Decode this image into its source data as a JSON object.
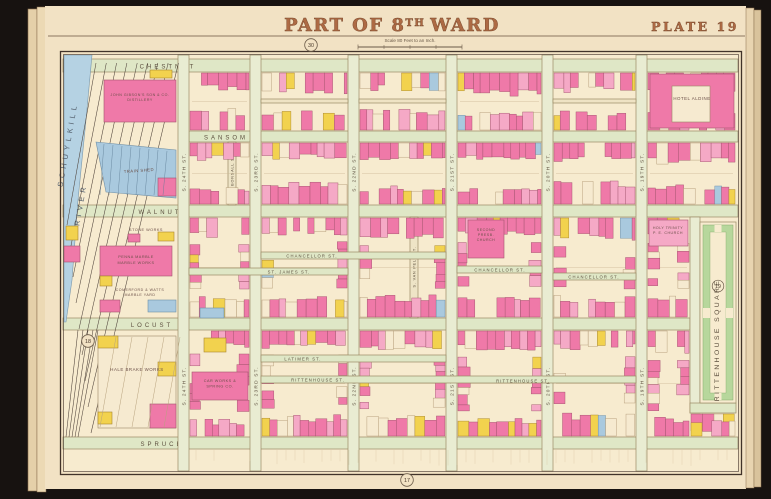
{
  "page": {
    "title_prefix": "PART OF 8",
    "title_sup": "TH",
    "title_suffix": "WARD",
    "plate_label": "PLATE 19",
    "scale_note": "Scale 80 Feet to an Inch."
  },
  "map": {
    "colors": {
      "dark": "#171210",
      "paper": "#f2e2c4",
      "block": "#f7ebcf",
      "street": "#dfe7c6",
      "street_light": "#e9ecd2",
      "street_line": "#9b8a64",
      "pink": "#ef79a8",
      "pink_light": "#f5a9c6",
      "yellow": "#f2d24e",
      "blue": "#a9c9de",
      "cream": "#f6ead0",
      "river": "#b5d2e3",
      "square_green": "#b7d79c",
      "ink": "#5c4f3e",
      "frame": "#41332a",
      "title": "#a96740"
    },
    "river": {
      "line1": "SCHUYLKILL",
      "line2": "RIVER"
    },
    "square": {
      "name": "RITTENHOUSE SQUARE",
      "badge": "19"
    },
    "ref_circles": [
      {
        "n": "30",
        "x": 311,
        "y": 45
      },
      {
        "n": "18",
        "x": 88,
        "y": 341
      },
      {
        "n": "17",
        "x": 407,
        "y": 480
      }
    ],
    "h_streets": [
      {
        "label": "CHESTNUT",
        "x1": 63,
        "x2": 738,
        "y": 59,
        "h": 13,
        "lx": 168,
        "ly": 68.5
      },
      {
        "label": "SANSOM",
        "x1": 189,
        "x2": 738,
        "y": 131,
        "h": 11,
        "lx": 226,
        "ly": 139.5
      },
      {
        "label": "WALNUT",
        "x1": 63,
        "x2": 738,
        "y": 205,
        "h": 12,
        "lx": 160,
        "ly": 214
      },
      {
        "label": "LOCUST",
        "x1": 63,
        "x2": 690,
        "y": 318,
        "h": 12,
        "lx": 152,
        "ly": 327
      },
      {
        "label": "SPRUCE",
        "x1": 63,
        "x2": 738,
        "y": 437,
        "h": 12,
        "lx": 162,
        "ly": 446
      }
    ],
    "v_streets": [
      {
        "label": "S. 24TH ST.",
        "x": 178,
        "w": 11,
        "y1": 55,
        "y2": 471,
        "ly": [
          172,
          386
        ]
      },
      {
        "label": "S. 23RD ST.",
        "x": 250,
        "w": 11,
        "y1": 55,
        "y2": 471,
        "ly": [
          172,
          386
        ]
      },
      {
        "label": "S. 22ND ST.",
        "x": 348,
        "w": 11,
        "y1": 55,
        "y2": 471,
        "ly": [
          172,
          386
        ]
      },
      {
        "label": "S. 21ST ST.",
        "x": 446,
        "w": 11,
        "y1": 55,
        "y2": 471,
        "ly": [
          172,
          386
        ]
      },
      {
        "label": "S. 20TH ST.",
        "x": 542,
        "w": 11,
        "y1": 55,
        "y2": 471,
        "ly": [
          172,
          386
        ]
      },
      {
        "label": "S. 19TH ST.",
        "x": 636,
        "w": 11,
        "y1": 55,
        "y2": 471,
        "ly": [
          172,
          386
        ]
      },
      {
        "label": "",
        "x": 690,
        "w": 10,
        "y1": 217,
        "y2": 413,
        "ly": []
      }
    ],
    "minor_v": [
      {
        "label": "S. BONSALL ST.",
        "x": 228,
        "w": 8,
        "y1": 142,
        "y2": 205,
        "ly": 173
      },
      {
        "label": "S. VAN PELT ST.",
        "x": 410,
        "w": 8,
        "y1": 217,
        "y2": 318,
        "ly": 267
      }
    ],
    "alleys": [
      {
        "label": "CHANCELLOR ST.",
        "x1": 261,
        "x2": 446,
        "y": 252,
        "h": 7,
        "lx": 312,
        "ly": 257.5
      },
      {
        "label": "CHANCELLOR ST.",
        "x1": 457,
        "x2": 542,
        "y": 266,
        "h": 7,
        "lx": 500,
        "ly": 271.5
      },
      {
        "label": "CHANCELLOR ST.",
        "x1": 553,
        "x2": 636,
        "y": 273,
        "h": 7,
        "lx": 594,
        "ly": 278.5
      },
      {
        "label": "ST. JAMES ST.",
        "x1": 189,
        "x2": 348,
        "y": 268,
        "h": 7,
        "lx": 289,
        "ly": 273.5
      },
      {
        "label": "LATIMER ST.",
        "x1": 261,
        "x2": 446,
        "y": 355,
        "h": 7,
        "lx": 303,
        "ly": 360.5
      },
      {
        "label": "RITTENHOUSE ST.",
        "x1": 261,
        "x2": 636,
        "y": 376,
        "h": 7,
        "lx": 318,
        "ly": 381.5,
        "lx2": 523
      },
      {
        "label": "",
        "x1": 690,
        "x2": 736,
        "y": 403,
        "h": 10
      },
      {
        "label": "",
        "x1": 261,
        "x2": 348,
        "y": 99,
        "h": 4
      },
      {
        "label": "",
        "x1": 359,
        "x2": 446,
        "y": 99,
        "h": 4
      },
      {
        "label": "",
        "x1": 553,
        "x2": 636,
        "y": 99,
        "h": 4
      }
    ],
    "landmarks": [
      {
        "lines": [
          "JOHN GIBSON'S SON & CO.",
          "DISTILLERY"
        ],
        "x": 140,
        "y": 96,
        "fs": 3.6,
        "lh": 5
      },
      {
        "lines": [
          "TRAIN SHED"
        ],
        "x": 139,
        "y": 172,
        "fs": 4.2,
        "lh": 5,
        "rot": -4
      },
      {
        "lines": [
          "STONE WORKS"
        ],
        "x": 146,
        "y": 231,
        "fs": 3.8,
        "lh": 5
      },
      {
        "lines": [
          "PENNA MARBLE",
          "MARBLE WORKS"
        ],
        "x": 136,
        "y": 258,
        "fs": 3.8,
        "lh": 6
      },
      {
        "lines": [
          "COMERFORD & WATTS",
          "MARBLE YARD"
        ],
        "x": 140,
        "y": 291,
        "fs": 3.6,
        "lh": 5
      },
      {
        "lines": [
          "HALE BRAKE WORKS"
        ],
        "x": 137,
        "y": 371,
        "fs": 4.4,
        "lh": 5
      },
      {
        "lines": [
          "CAR WORKS &",
          "SPRING CO."
        ],
        "x": 220,
        "y": 382,
        "fs": 3.8,
        "lh": 5.5
      },
      {
        "lines": [
          "HOTEL ALDINE"
        ],
        "x": 692,
        "y": 100,
        "fs": 4.4,
        "lh": 5
      },
      {
        "lines": [
          "SECOND",
          "PRESB.",
          "CHURCH"
        ],
        "x": 486,
        "y": 231,
        "fs": 3.6,
        "lh": 5
      },
      {
        "lines": [
          "HOLY TRINITY",
          "P. E. CHURCH"
        ],
        "x": 668,
        "y": 229,
        "fs": 3.6,
        "lh": 5
      }
    ]
  }
}
